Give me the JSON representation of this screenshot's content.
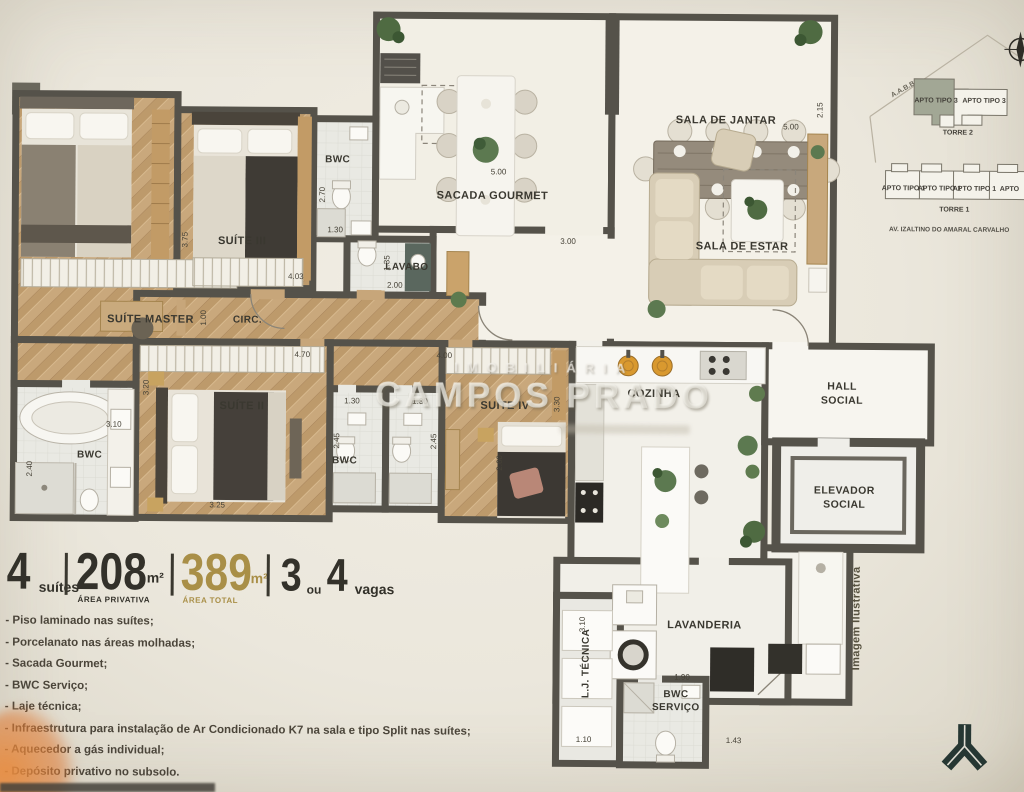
{
  "floorplan": {
    "rooms": {
      "suite_master": "SUÍTE MASTER",
      "suite_iii": "SUÍTE III",
      "suite_ii": "SUÍTE II",
      "suite_iv": "SUÍTE IV",
      "bwc_suite3": "BWC",
      "bwc_suites": "BWC",
      "bwc_master": "BWC",
      "lavabo": "LAVABO",
      "circ": "CIRC.",
      "sacada": "SACADA GOURMET",
      "jantar": "SALA DE JANTAR",
      "estar": "SALA DE ESTAR",
      "cozinha": "COZINHA",
      "hall": "HALL SOCIAL",
      "elevador": "ELEVADOR SOCIAL",
      "lavanderia": "LAVANDERIA",
      "bwc_servico": "BWC SERVIÇO",
      "lj_tecnica": "L.J. TÉCNICA"
    },
    "dims": {
      "s3_depth": "3.75",
      "s3_width": "4.03",
      "bwc3_depth": "2.70",
      "bwc3_width": "1.30",
      "lavabo_depth": "1.35",
      "lavabo_width": "2.00",
      "circ_width": "1.00",
      "sacada_width": "5.00",
      "sacada_side": "3.00",
      "jantar_width": "5.00",
      "living_side": "2.15",
      "s2_depth": "3.20",
      "s2_width": "3.25",
      "s2_top": "4.70",
      "bwc2_depth": "2.45",
      "bwc2_width": "1.30",
      "bwc4_depth": "2.45",
      "bwc4_width": "1.30",
      "s4_top": "4.00",
      "s4_depth": "2.60",
      "s4_side": "3.30",
      "mbwc_width": "3.10",
      "mbwc_depth": "2.40",
      "lav_depth": "3.10",
      "lav_width": "1.90",
      "ljt_width": "1.10",
      "serv_width": "1.43"
    },
    "watermark": {
      "line1": "IMOBILIÁRIA",
      "line2": "CAMPOS PRADO"
    },
    "note_vertical": "Imagem Ilustrativa"
  },
  "keyplan": {
    "area_label": "A.A.B.B",
    "torre2": {
      "unit_left": "APTO TIPO 3",
      "unit_right": "APTO TIPO 3",
      "caption": "TORRE 2"
    },
    "torre1": {
      "units": [
        "APTO TIPO 1",
        "APTO TIPO 1",
        "APTO TIPO 1",
        "APTO"
      ],
      "caption": "TORRE 1"
    },
    "street": "AV. IZALTINO DO AMARAL CARVALHO"
  },
  "specs": {
    "suites": {
      "value": "4",
      "label": "suítes"
    },
    "privativa": {
      "value": "208",
      "unit": "m²",
      "label": "ÁREA PRIVATIVA"
    },
    "total": {
      "value": "389",
      "unit": "m²",
      "label": "ÁREA TOTAL"
    },
    "vagas": {
      "value1": "3",
      "conj": "ou",
      "value2": "4",
      "label": "vagas"
    },
    "accent_gold": "#a98f47"
  },
  "features": [
    "- Piso laminado nas suítes;",
    "- Porcelanato nas áreas molhadas;",
    "- Sacada Gourmet;",
    "- BWC Serviço;",
    "- Laje técnica;",
    "- Infraestrutura para instalação de Ar Condicionado K7 na sala e tipo Split nas suítes;",
    "- Aquecedor a gás individual;",
    "- Depósito privativo no subsolo."
  ]
}
